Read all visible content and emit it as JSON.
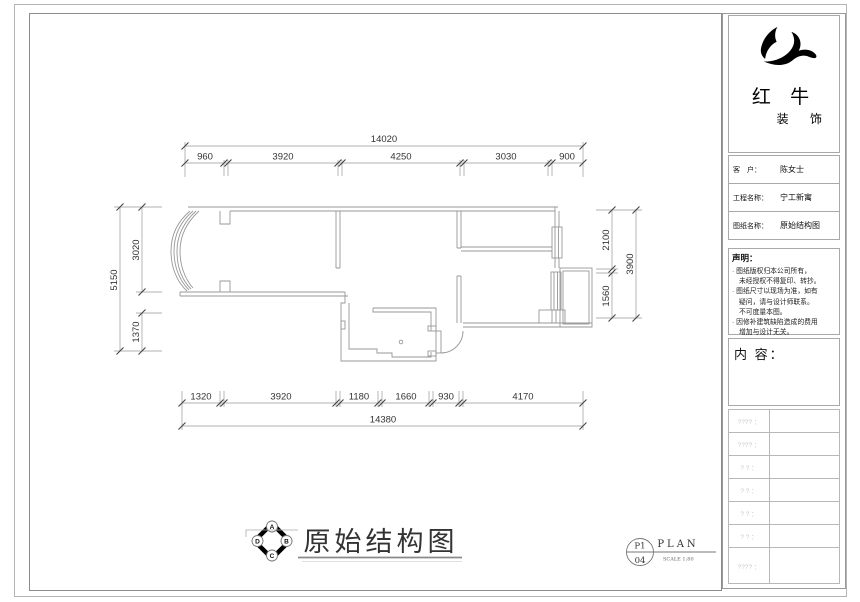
{
  "colors": {
    "wall_line": "#979797",
    "dim_line": "#8a8a8a",
    "dim_text": "#333333",
    "placeholder_text": "#c9c9c9",
    "logo_ink": "#000000"
  },
  "logo": {
    "line1": "红 牛",
    "line2": "装 饰",
    "mark": "bull-swoosh"
  },
  "title_block": {
    "rows": [
      {
        "label": "客　户：",
        "value": "陈女士"
      },
      {
        "label": "工程名称：",
        "value": "宁工新寓"
      },
      {
        "label": "图纸名称：",
        "value": "原始结构图"
      }
    ],
    "statement": {
      "heading": "声明：",
      "lines": [
        "· 图纸版权归本公司所有，",
        "未经授权不得复印、转抄。",
        "· 图纸尺寸以现场为准，如有",
        "疑问，请与设计师联系。",
        "不可度量本图。",
        "· 因修补建筑缺陷造成的费用",
        "增加与设计无关。"
      ]
    },
    "content_heading": "内 容：",
    "placeholder_rows": [
      "???? ：",
      "???? ：",
      "? ? ：",
      "? ? ：",
      "? ? ：",
      "? ? ：",
      "???? ："
    ]
  },
  "plan": {
    "dims_top": {
      "overall": "14020",
      "segments": [
        "960",
        "3920",
        "4250",
        "3030",
        "900"
      ]
    },
    "dims_bottom": {
      "overall": "14380",
      "segments": [
        "1320",
        "3920",
        "1180",
        "1660",
        "930",
        "4170"
      ]
    },
    "dims_left": {
      "overall": "5150",
      "segments": [
        "3020",
        "1370"
      ]
    },
    "dims_right": {
      "overall": "3900",
      "segments": [
        "2100",
        "1560"
      ]
    }
  },
  "footer": {
    "drawing_title": "原始结构图",
    "compass": {
      "top": "A",
      "right": "B",
      "bottom": "C",
      "left": "D"
    },
    "sheet": {
      "number_top": "P1",
      "number_bottom": "04",
      "type_label": "PLAN",
      "scale_label": "SCALE 1:80"
    }
  }
}
